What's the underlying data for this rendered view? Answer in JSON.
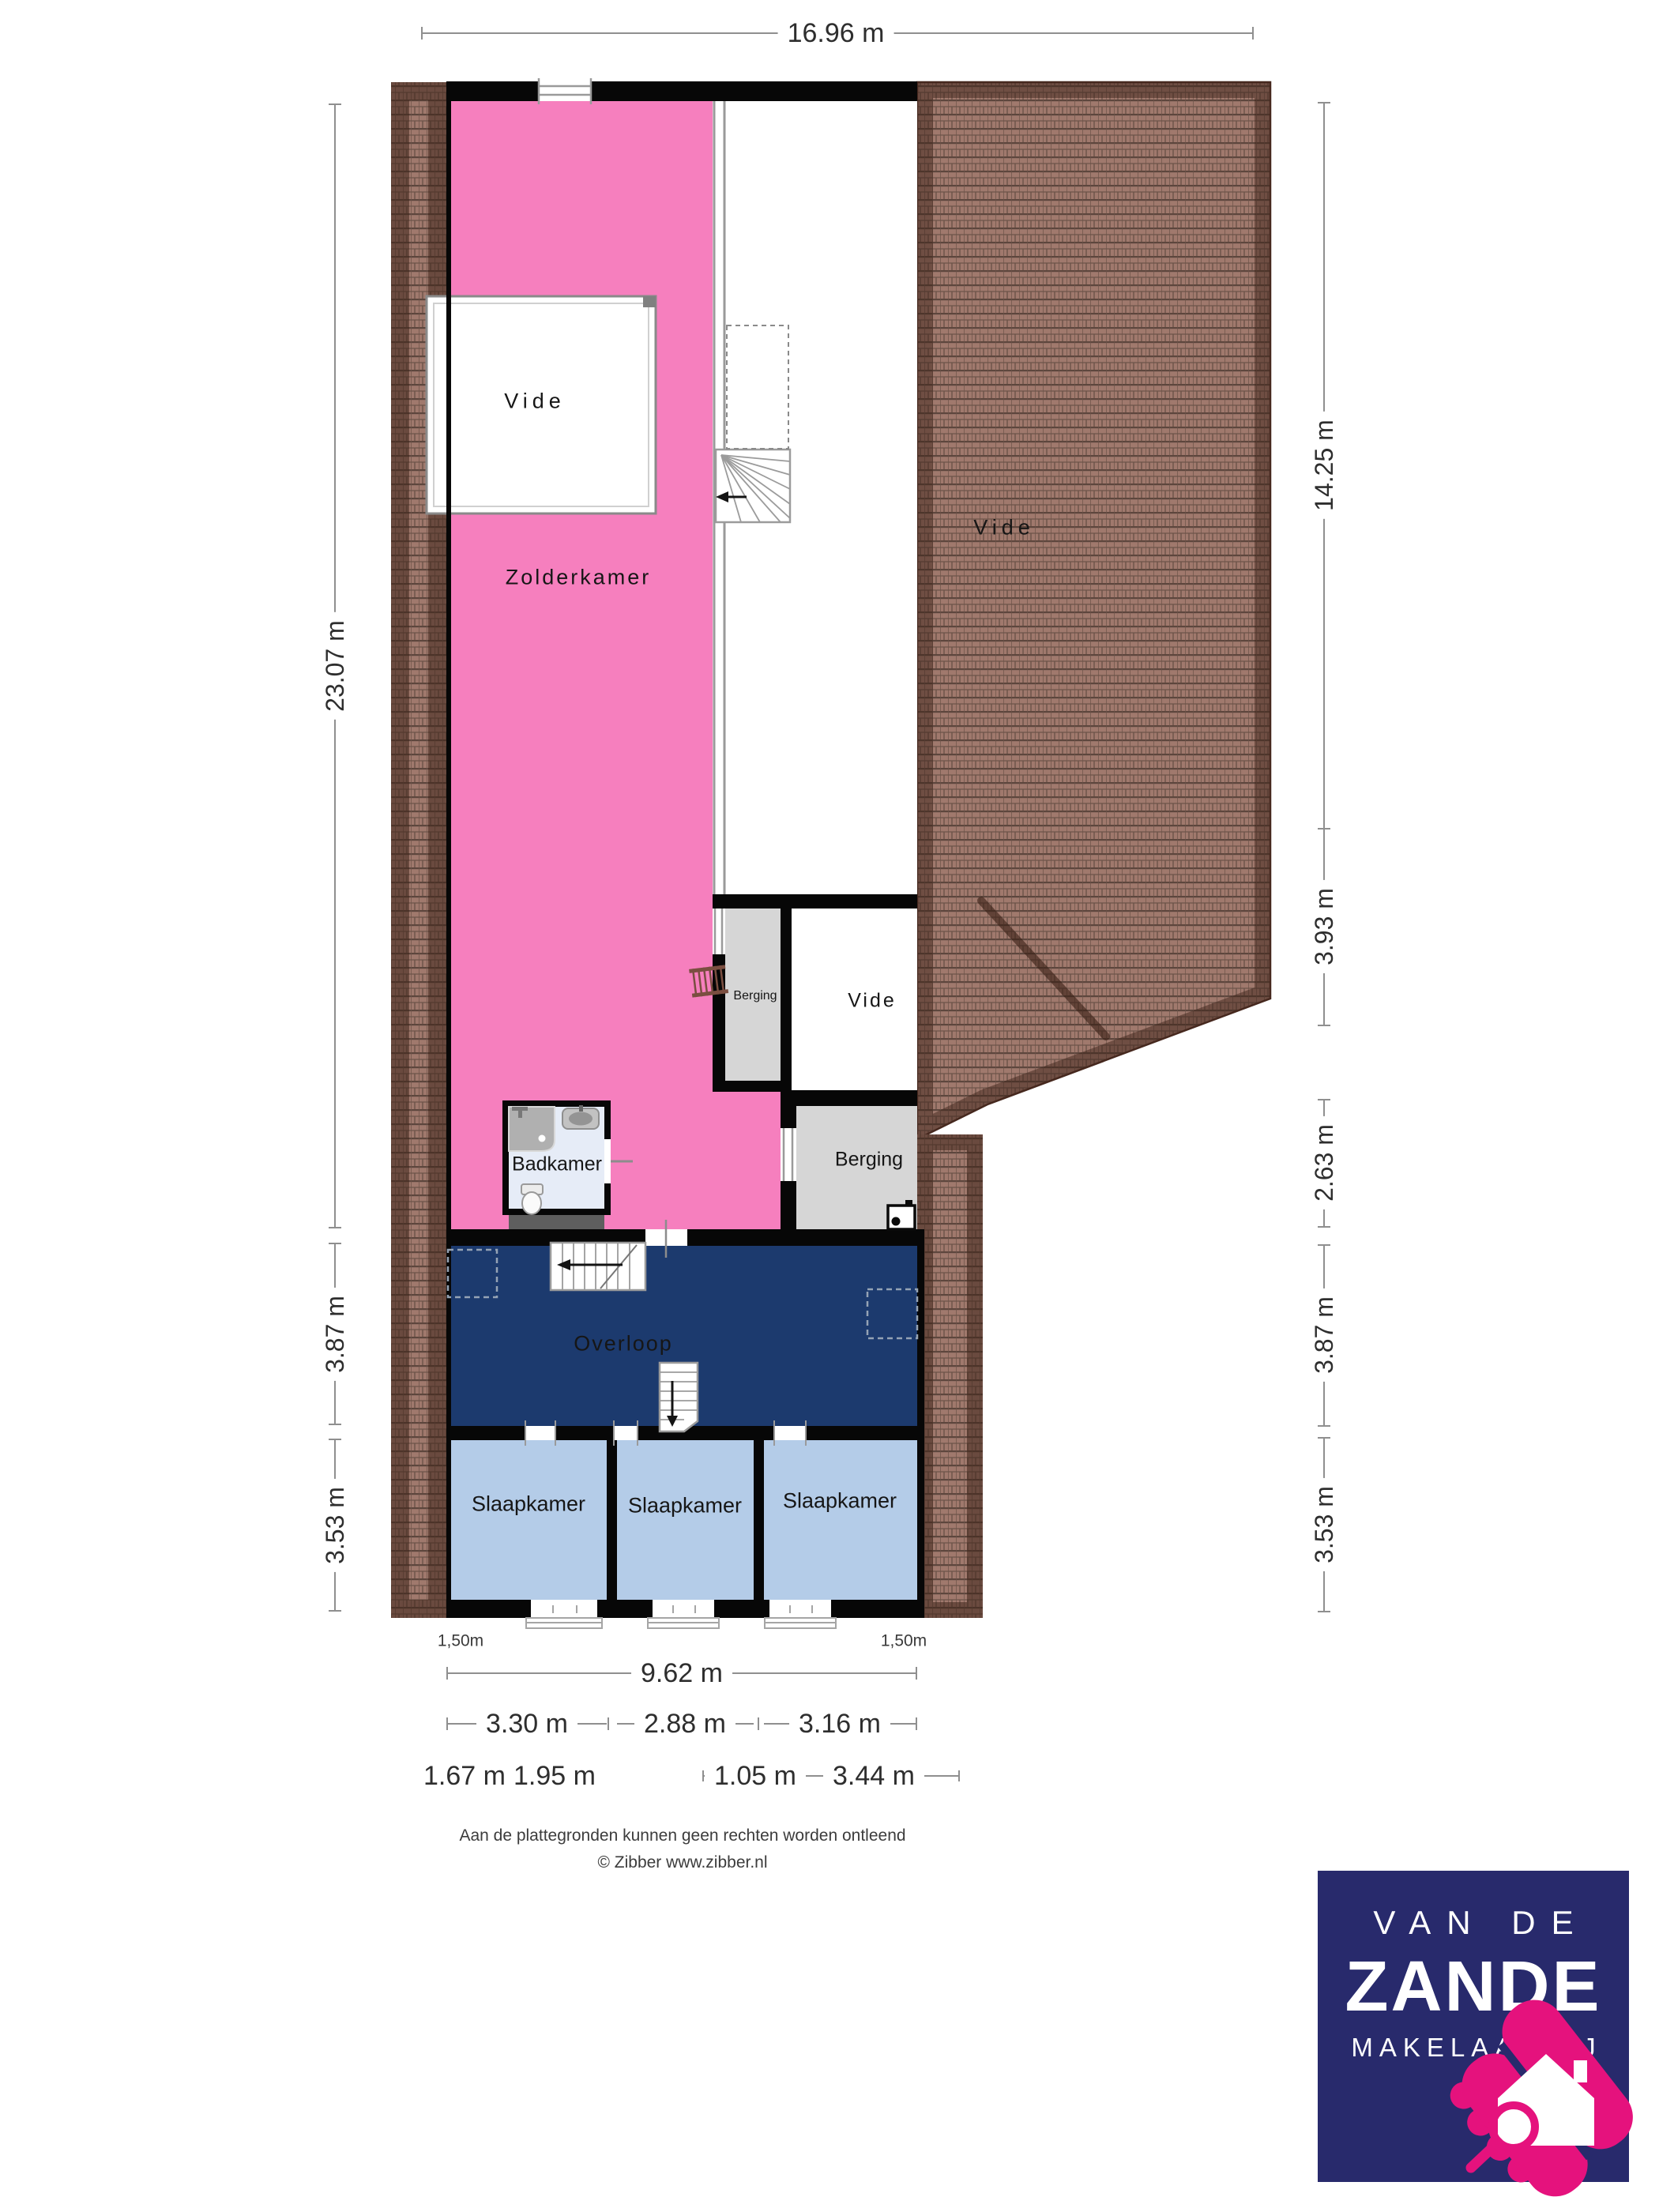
{
  "plan": {
    "rooms": {
      "zolderkamer": "Zolderkamer",
      "vide_top": "Vide",
      "vide_right": "Vide",
      "vide_middle": "Vide",
      "berging_small": "Berging",
      "berging_right": "Berging",
      "badkamer": "Badkamer",
      "overloop": "Overloop",
      "slaapkamer_left": "Slaapkamer",
      "slaapkamer_middle": "Slaapkamer",
      "slaapkamer_right": "Slaapkamer"
    },
    "dimensions": {
      "top_width": "16.96 m",
      "left": [
        "23.07 m",
        "3.87 m",
        "3.53 m"
      ],
      "right": [
        "14.25 m",
        "3.93 m",
        "2.63 m",
        "3.87 m",
        "3.53 m"
      ],
      "bottom_total": "9.62 m",
      "bottom_rooms": [
        "3.30 m",
        "2.88 m",
        "3.16 m"
      ],
      "bottom_detail": [
        "1.67 m",
        "1.95 m",
        "1.05 m",
        "3.44 m"
      ],
      "height_marker_left": "1,50m",
      "height_marker_right": "1,50m"
    }
  },
  "footer": {
    "disclaimer": "Aan de plattegronden kunnen geen rechten worden ontleend",
    "copyright": "© Zibber www.zibber.nl"
  },
  "logo": {
    "line1": "VAN DE",
    "line2": "ZANDE",
    "line3": "MAKELAARDIJ"
  },
  "colors": {
    "pink": "#F67FBE",
    "navy": "#1C3A6E",
    "bed": "#B4CCE8",
    "gray": "#D6D6D6",
    "bath": "#E6ECF7",
    "wall": "#070707",
    "roof": "#A0796D",
    "roof_dark": "#5D463D",
    "logo_navy": "#282A6C",
    "logo_pink": "#E5127D",
    "dim_line": "#8F8F8F"
  }
}
